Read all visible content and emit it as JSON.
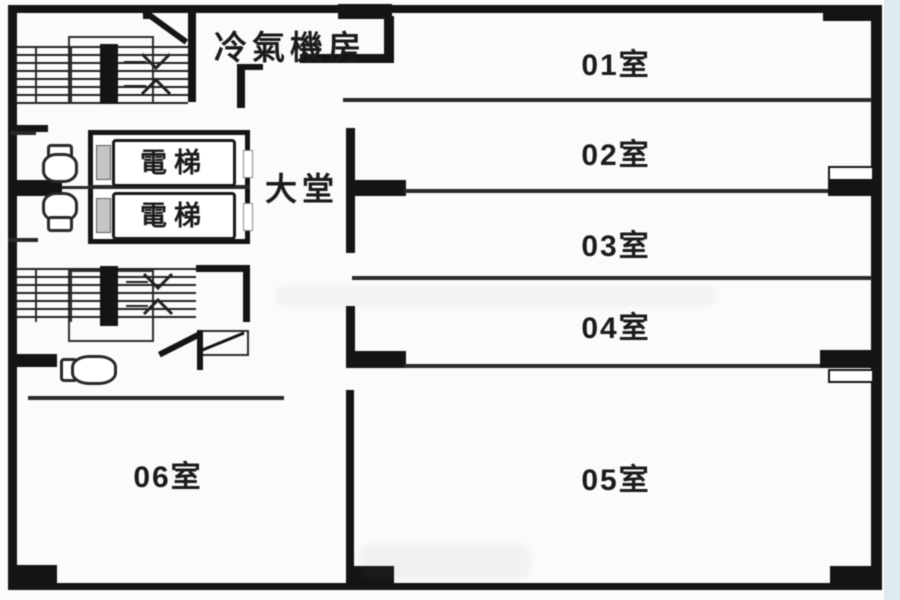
{
  "plan": {
    "machine_room_label": "冷氣機房",
    "lobby_label": "大堂",
    "elevators": [
      {
        "label": "電梯"
      },
      {
        "label": "電梯"
      }
    ],
    "rooms": [
      {
        "id": "01",
        "label": "01室"
      },
      {
        "id": "02",
        "label": "02室"
      },
      {
        "id": "03",
        "label": "03室"
      },
      {
        "id": "04",
        "label": "04室"
      },
      {
        "id": "05",
        "label": "05室"
      },
      {
        "id": "06",
        "label": "06室"
      }
    ],
    "colors": {
      "line": "#161616",
      "paper": "#fbfbfa",
      "margin_strip": "#dfeaee",
      "door_gray": "#c4c4c4"
    }
  }
}
